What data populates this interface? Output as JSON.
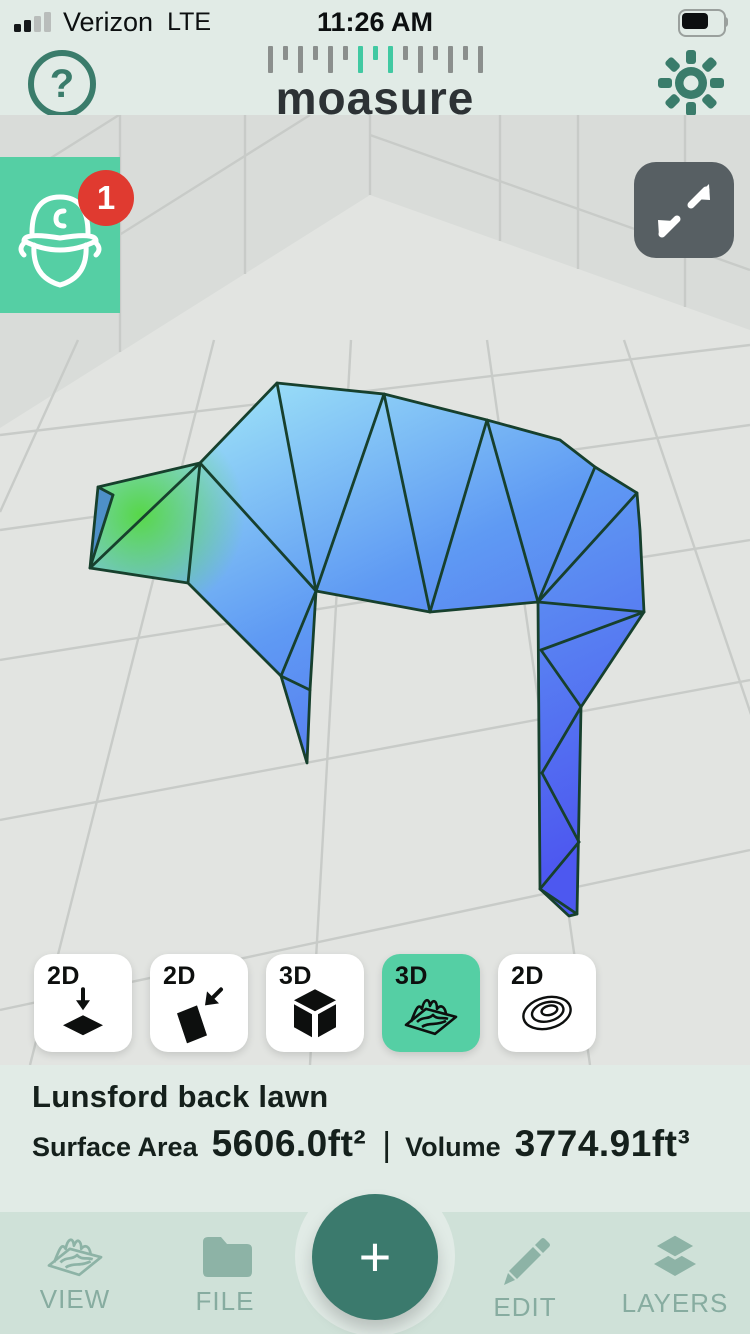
{
  "status_bar": {
    "carrier": "Verizon",
    "network": "LTE",
    "time": "11:26 AM"
  },
  "header": {
    "logo_text": "moasure",
    "logo_ticks": {
      "count": 15,
      "teal_indices": [
        6,
        7,
        8
      ],
      "gray": "#8b8f8d",
      "teal": "#41c9a2"
    },
    "accent_color": "#3a7c6b"
  },
  "viewport": {
    "notification_count": "1",
    "worker_badge_color": "#55cfa4",
    "notification_color": "#e03a30",
    "expand_button_color": "#575f63",
    "scene": {
      "floor_color": "#e2e4e1",
      "wall_color": "#d9dcd9",
      "grid_color": "#c8cbc8",
      "wall_polygon": [
        [
          0,
          115
        ],
        [
          750,
          115
        ],
        [
          750,
          330
        ],
        [
          370,
          195
        ],
        [
          0,
          428
        ]
      ],
      "wall_lines": [
        [
          120,
          115,
          120,
          352
        ],
        [
          245,
          115,
          245,
          274
        ],
        [
          370,
          115,
          370,
          195
        ],
        [
          500,
          115,
          500,
          241
        ],
        [
          578,
          115,
          578,
          269
        ],
        [
          685,
          115,
          685,
          307
        ],
        [
          0,
          310,
          310,
          115
        ],
        [
          0,
          190,
          119,
          115
        ],
        [
          370,
          135,
          750,
          270
        ]
      ],
      "floor_lines": [
        [
          0,
          435,
          750,
          345
        ],
        [
          0,
          530,
          750,
          425
        ],
        [
          0,
          660,
          750,
          540
        ],
        [
          0,
          820,
          750,
          680
        ],
        [
          0,
          1010,
          750,
          850
        ],
        [
          78,
          340,
          0,
          512
        ],
        [
          214,
          340,
          30,
          1065
        ],
        [
          351,
          340,
          310,
          1065
        ],
        [
          487,
          340,
          590,
          1065
        ],
        [
          624,
          340,
          870,
          1065
        ]
      ],
      "mesh": {
        "edge_color": "#17402d",
        "outline": [
          [
            98,
            487
          ],
          [
            200,
            463
          ],
          [
            277,
            383
          ],
          [
            384,
            394
          ],
          [
            487,
            420
          ],
          [
            560,
            440
          ],
          [
            595,
            467
          ],
          [
            637,
            493
          ],
          [
            640,
            530
          ],
          [
            644,
            612
          ],
          [
            581,
            707
          ],
          [
            577,
            914
          ],
          [
            569,
            916
          ],
          [
            540,
            889
          ],
          [
            538,
            602
          ],
          [
            430,
            612
          ],
          [
            316,
            591
          ],
          [
            310,
            690
          ],
          [
            307,
            763
          ],
          [
            281,
            676
          ],
          [
            188,
            583
          ],
          [
            90,
            568
          ]
        ],
        "edges": [
          [
            113,
            495,
            90,
            568
          ],
          [
            200,
            463,
            90,
            568
          ],
          [
            200,
            463,
            188,
            583
          ],
          [
            200,
            463,
            316,
            591
          ],
          [
            277,
            383,
            316,
            591
          ],
          [
            384,
            394,
            316,
            591
          ],
          [
            384,
            394,
            430,
            612
          ],
          [
            487,
            420,
            430,
            612
          ],
          [
            487,
            420,
            538,
            602
          ],
          [
            595,
            467,
            538,
            602
          ],
          [
            637,
            493,
            538,
            602
          ],
          [
            644,
            612,
            538,
            602
          ],
          [
            644,
            612,
            541,
            650
          ],
          [
            541,
            650,
            581,
            707
          ],
          [
            581,
            707,
            542,
            773
          ],
          [
            542,
            773,
            579,
            842
          ],
          [
            579,
            842,
            540,
            889
          ],
          [
            540,
            889,
            577,
            914
          ],
          [
            316,
            591,
            281,
            676
          ],
          [
            310,
            690,
            281,
            676
          ],
          [
            98,
            487,
            113,
            495
          ]
        ],
        "gradient_stops": [
          [
            "0",
            "#a3e9f8"
          ],
          [
            "0.45",
            "#5f9af3"
          ],
          [
            "1",
            "#4d58f0"
          ]
        ],
        "green_spot": {
          "cx": 140,
          "cy": 515,
          "r": 105,
          "color": "#55d840"
        },
        "tip_sliver": {
          "points": [
            [
              98,
              487
            ],
            [
              113,
              495
            ],
            [
              90,
              568
            ]
          ],
          "color": "#4e90c8"
        }
      }
    }
  },
  "view_modes": [
    {
      "label": "2D",
      "icon": "plan-flatten-icon",
      "selected": false
    },
    {
      "label": "2D",
      "icon": "side-flatten-icon",
      "selected": false
    },
    {
      "label": "3D",
      "icon": "cube-icon",
      "selected": false
    },
    {
      "label": "3D",
      "icon": "surface-icon",
      "selected": true
    },
    {
      "label": "2D",
      "icon": "contour-icon",
      "selected": false
    }
  ],
  "selected_mode_color": "#55cfa4",
  "info": {
    "title": "Lunsford back lawn",
    "surface_area_label": "Surface Area",
    "surface_area_value": "5606.0ft²",
    "separator": "|",
    "volume_label": "Volume",
    "volume_value": "3774.91ft³"
  },
  "bottom_nav": {
    "bar_color": "#cfe1d8",
    "muted_icon_color": "#8db3a6",
    "add_button_color": "#3b7a6d",
    "add_button_label": "+",
    "items": [
      {
        "label": "VIEW",
        "icon": "surface-icon"
      },
      {
        "label": "FILE",
        "icon": "folder-icon"
      },
      {
        "label": "EDIT",
        "icon": "pencil-icon"
      },
      {
        "label": "LAYERS",
        "icon": "layers-icon"
      }
    ]
  }
}
